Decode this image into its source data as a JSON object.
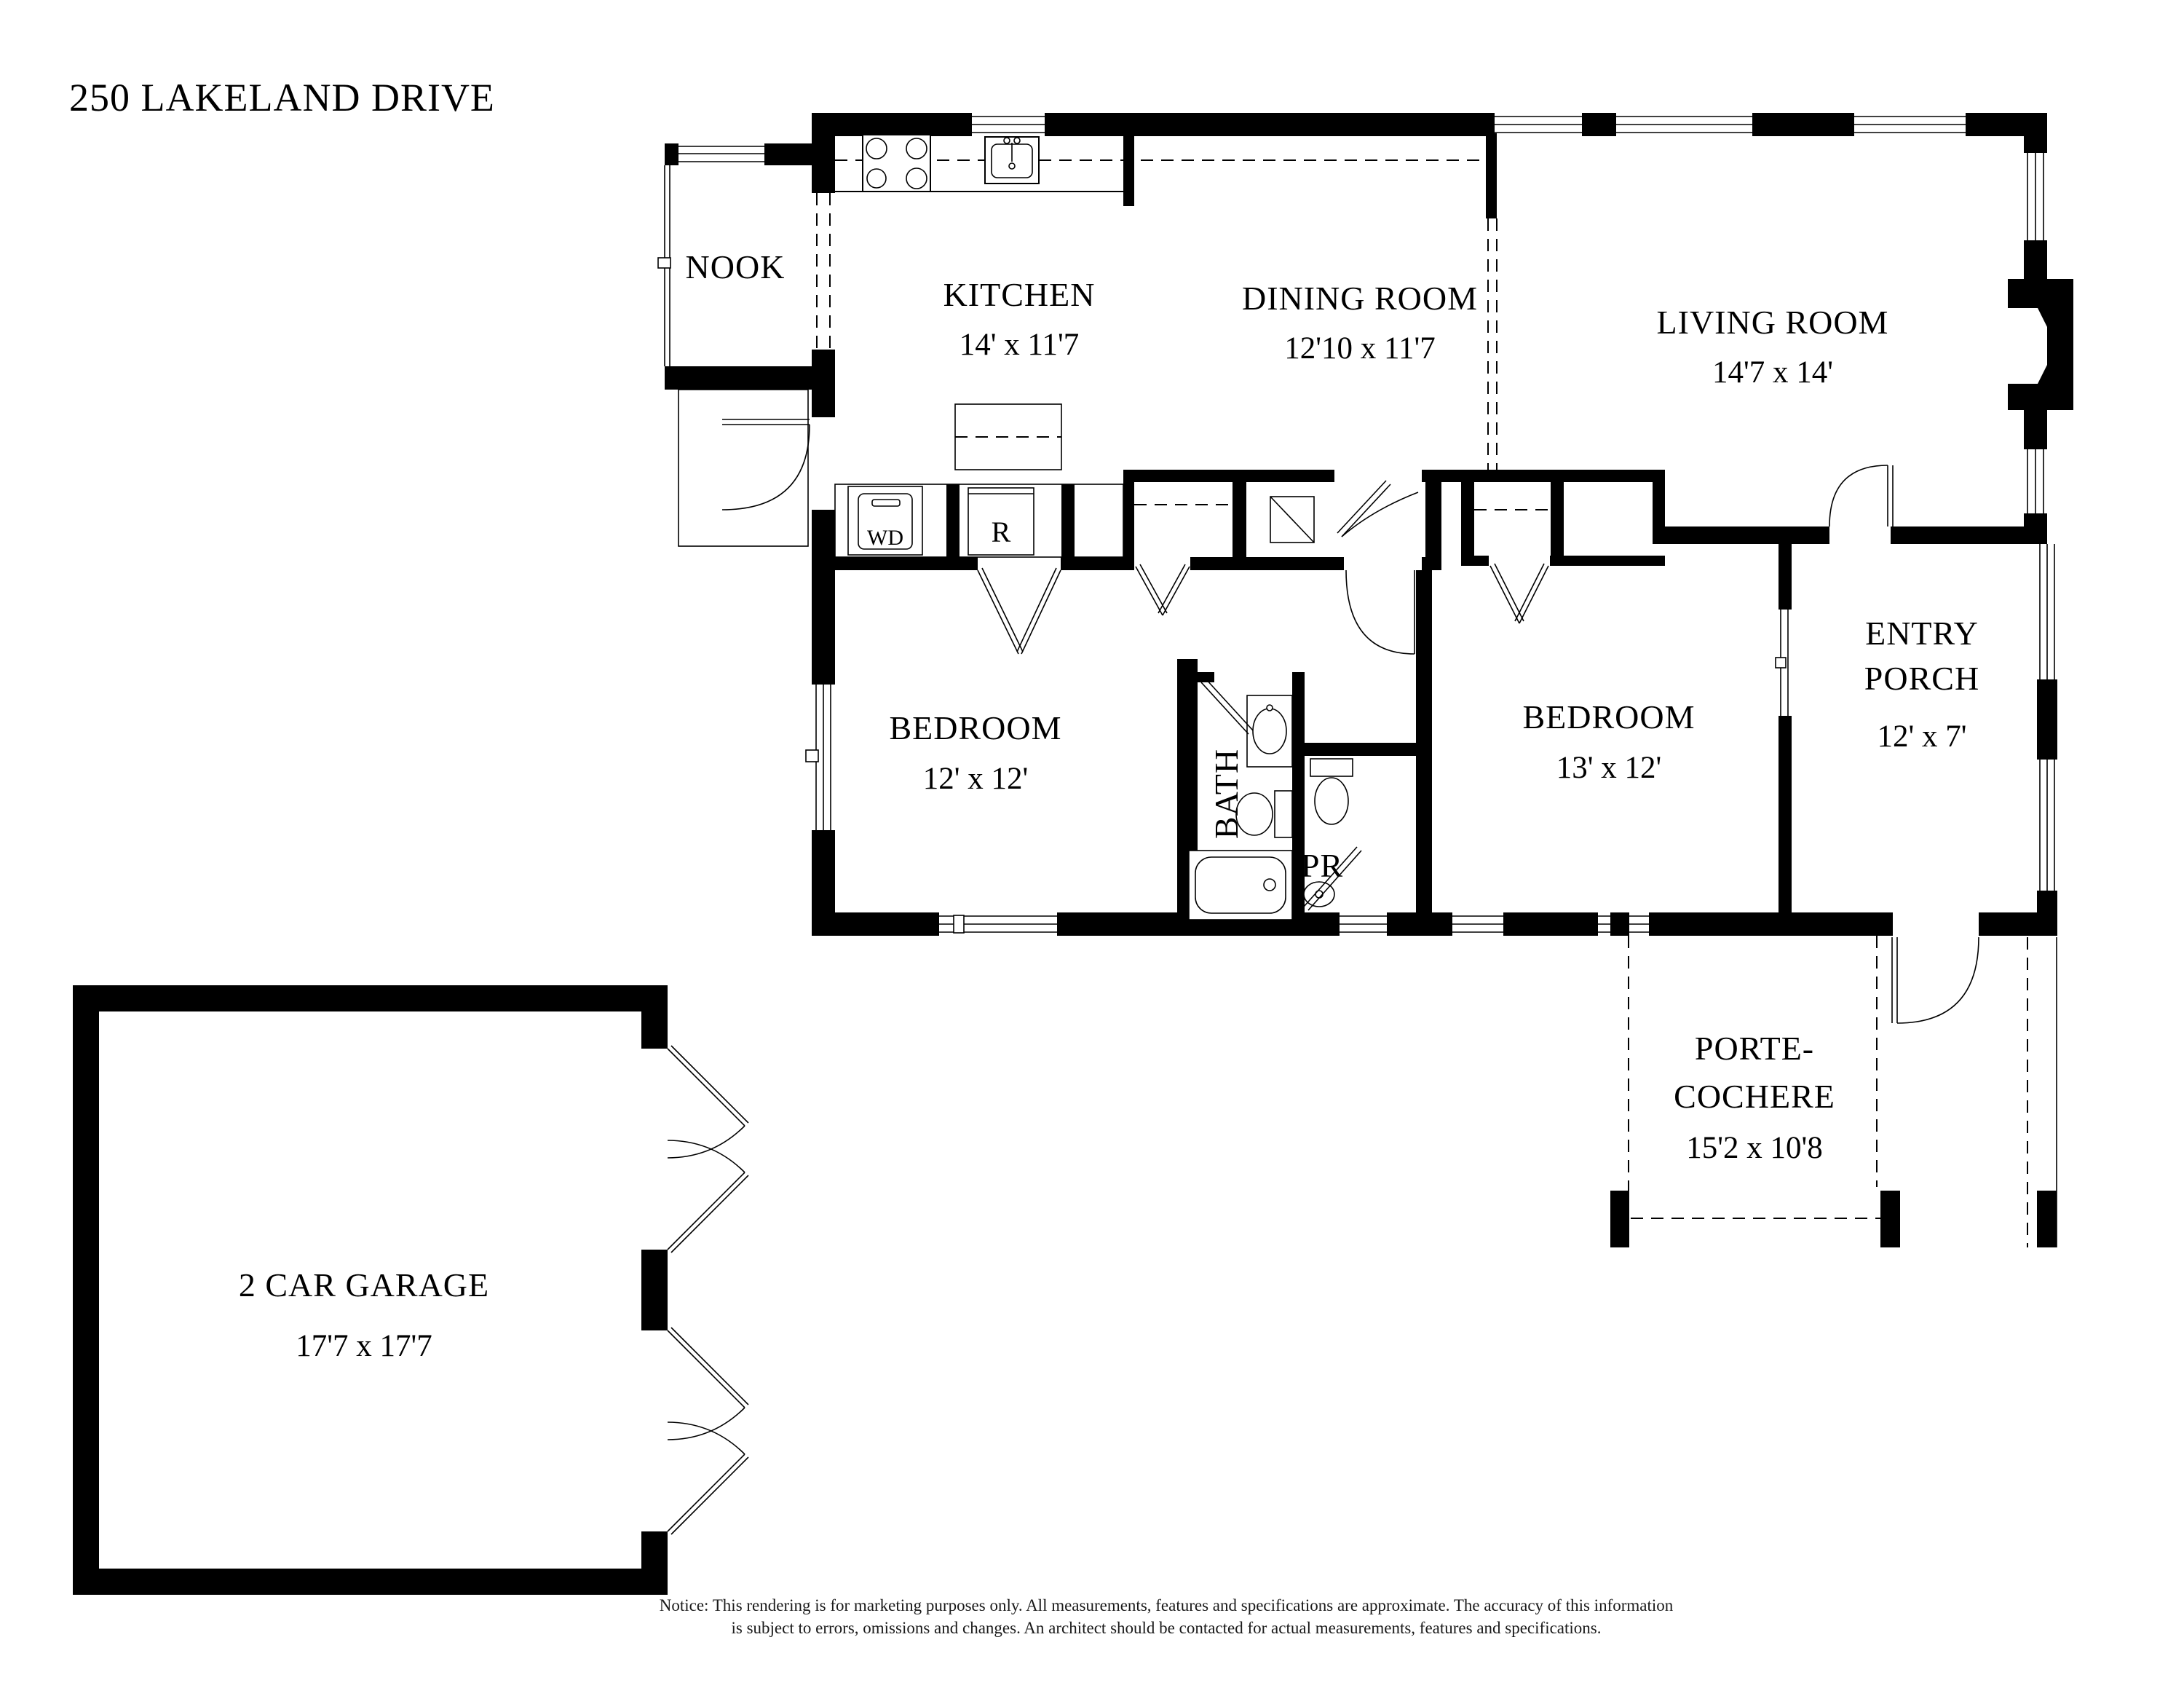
{
  "title": "250 LAKELAND DRIVE",
  "colors": {
    "wall": "#000000",
    "background": "#ffffff"
  },
  "rooms": {
    "nook": {
      "name": "NOOK"
    },
    "kitchen": {
      "name": "KITCHEN",
      "dims": "14' x 11'7"
    },
    "dining": {
      "name": "DINING ROOM",
      "dims": "12'10 x 11'7"
    },
    "living": {
      "name": "LIVING ROOM",
      "dims": "14'7 x 14'"
    },
    "bedroom1": {
      "name": "BEDROOM",
      "dims": "12' x 12'"
    },
    "bath": {
      "name": "BATH"
    },
    "powder": {
      "name": "PR"
    },
    "bedroom2": {
      "name": "BEDROOM",
      "dims": "13' x 12'"
    },
    "entry_porch": {
      "line1": "ENTRY",
      "line2": "PORCH",
      "dims": "12' x 7'"
    },
    "porte_cochere": {
      "line1": "PORTE-",
      "line2": "COCHERE",
      "dims": "15'2 x 10'8"
    },
    "garage": {
      "name": "2 CAR GARAGE",
      "dims": "17'7 x 17'7"
    }
  },
  "appliances": {
    "washer_dryer": "WD",
    "refrigerator": "R"
  },
  "notice": {
    "line1": "Notice: This rendering is for marketing purposes only. All measurements, features and specifications are approximate. The accuracy of this information",
    "line2": "is subject to errors, omissions and changes. An architect should be contacted for actual measurements, features and specifications."
  }
}
